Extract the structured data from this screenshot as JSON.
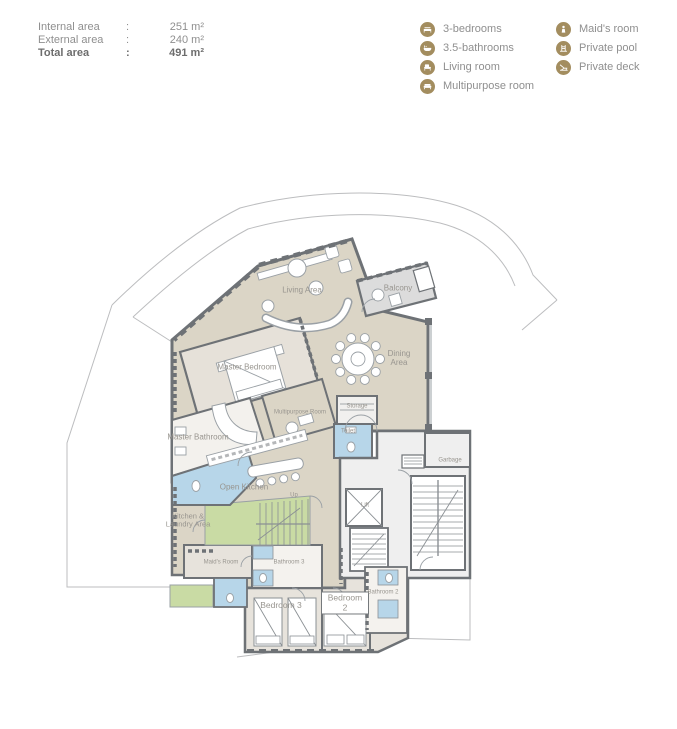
{
  "header": {
    "areas": [
      {
        "label": "Internal area",
        "separator": ":",
        "value": "251 m²"
      },
      {
        "label": "External area",
        "separator": ":",
        "value": "240 m²"
      },
      {
        "label": "Total area",
        "separator": ":",
        "value": "491 m²"
      }
    ]
  },
  "legend": {
    "accent_color": "#a38d5f",
    "column1": [
      {
        "icon": "bed-icon",
        "label": "3-bedrooms"
      },
      {
        "icon": "bathtub-icon",
        "label": "3.5-bathrooms"
      },
      {
        "icon": "armchair-icon",
        "label": "Living room"
      },
      {
        "icon": "sofa-icon",
        "label": "Multipurpose room"
      }
    ],
    "column2": [
      {
        "icon": "maid-icon",
        "label": "Maid's room"
      },
      {
        "icon": "pool-ladder-icon",
        "label": "Private pool"
      },
      {
        "icon": "deck-chair-icon",
        "label": "Private deck"
      }
    ]
  },
  "floor_plan": {
    "colors": {
      "floor_beige": "#dbd5c6",
      "bedroom_floor": "#e7e3dc",
      "bathroom_blue": "#b7d6e9",
      "stair_green": "#c9dba4",
      "core_floor": "#efefef",
      "balcony_gray": "#dcdcdc",
      "wall_gray": "#6e7276"
    },
    "rooms": {
      "living_area": "Living Area",
      "balcony": "Balcony",
      "dining_area": "Dining Area",
      "master_bedroom": "Master Bedroom",
      "master_bathroom": "Master Bathroom",
      "multipurpose_room": "Multipurpose Room",
      "storage": "Storage",
      "toilet": "Toilet",
      "garbage": "Garbage",
      "open_kitchen": "Open Kitchen",
      "up": "Up",
      "lift": "Lift",
      "kitchen_laundry": "Kitchen & Laundry Area",
      "maids_room": "Maid's Room",
      "bathroom_3": "Bathroom 3",
      "bedroom_3": "Bedroom 3",
      "bedroom_2": "Bedroom 2",
      "bathroom_2": "Bathroom 2"
    }
  }
}
